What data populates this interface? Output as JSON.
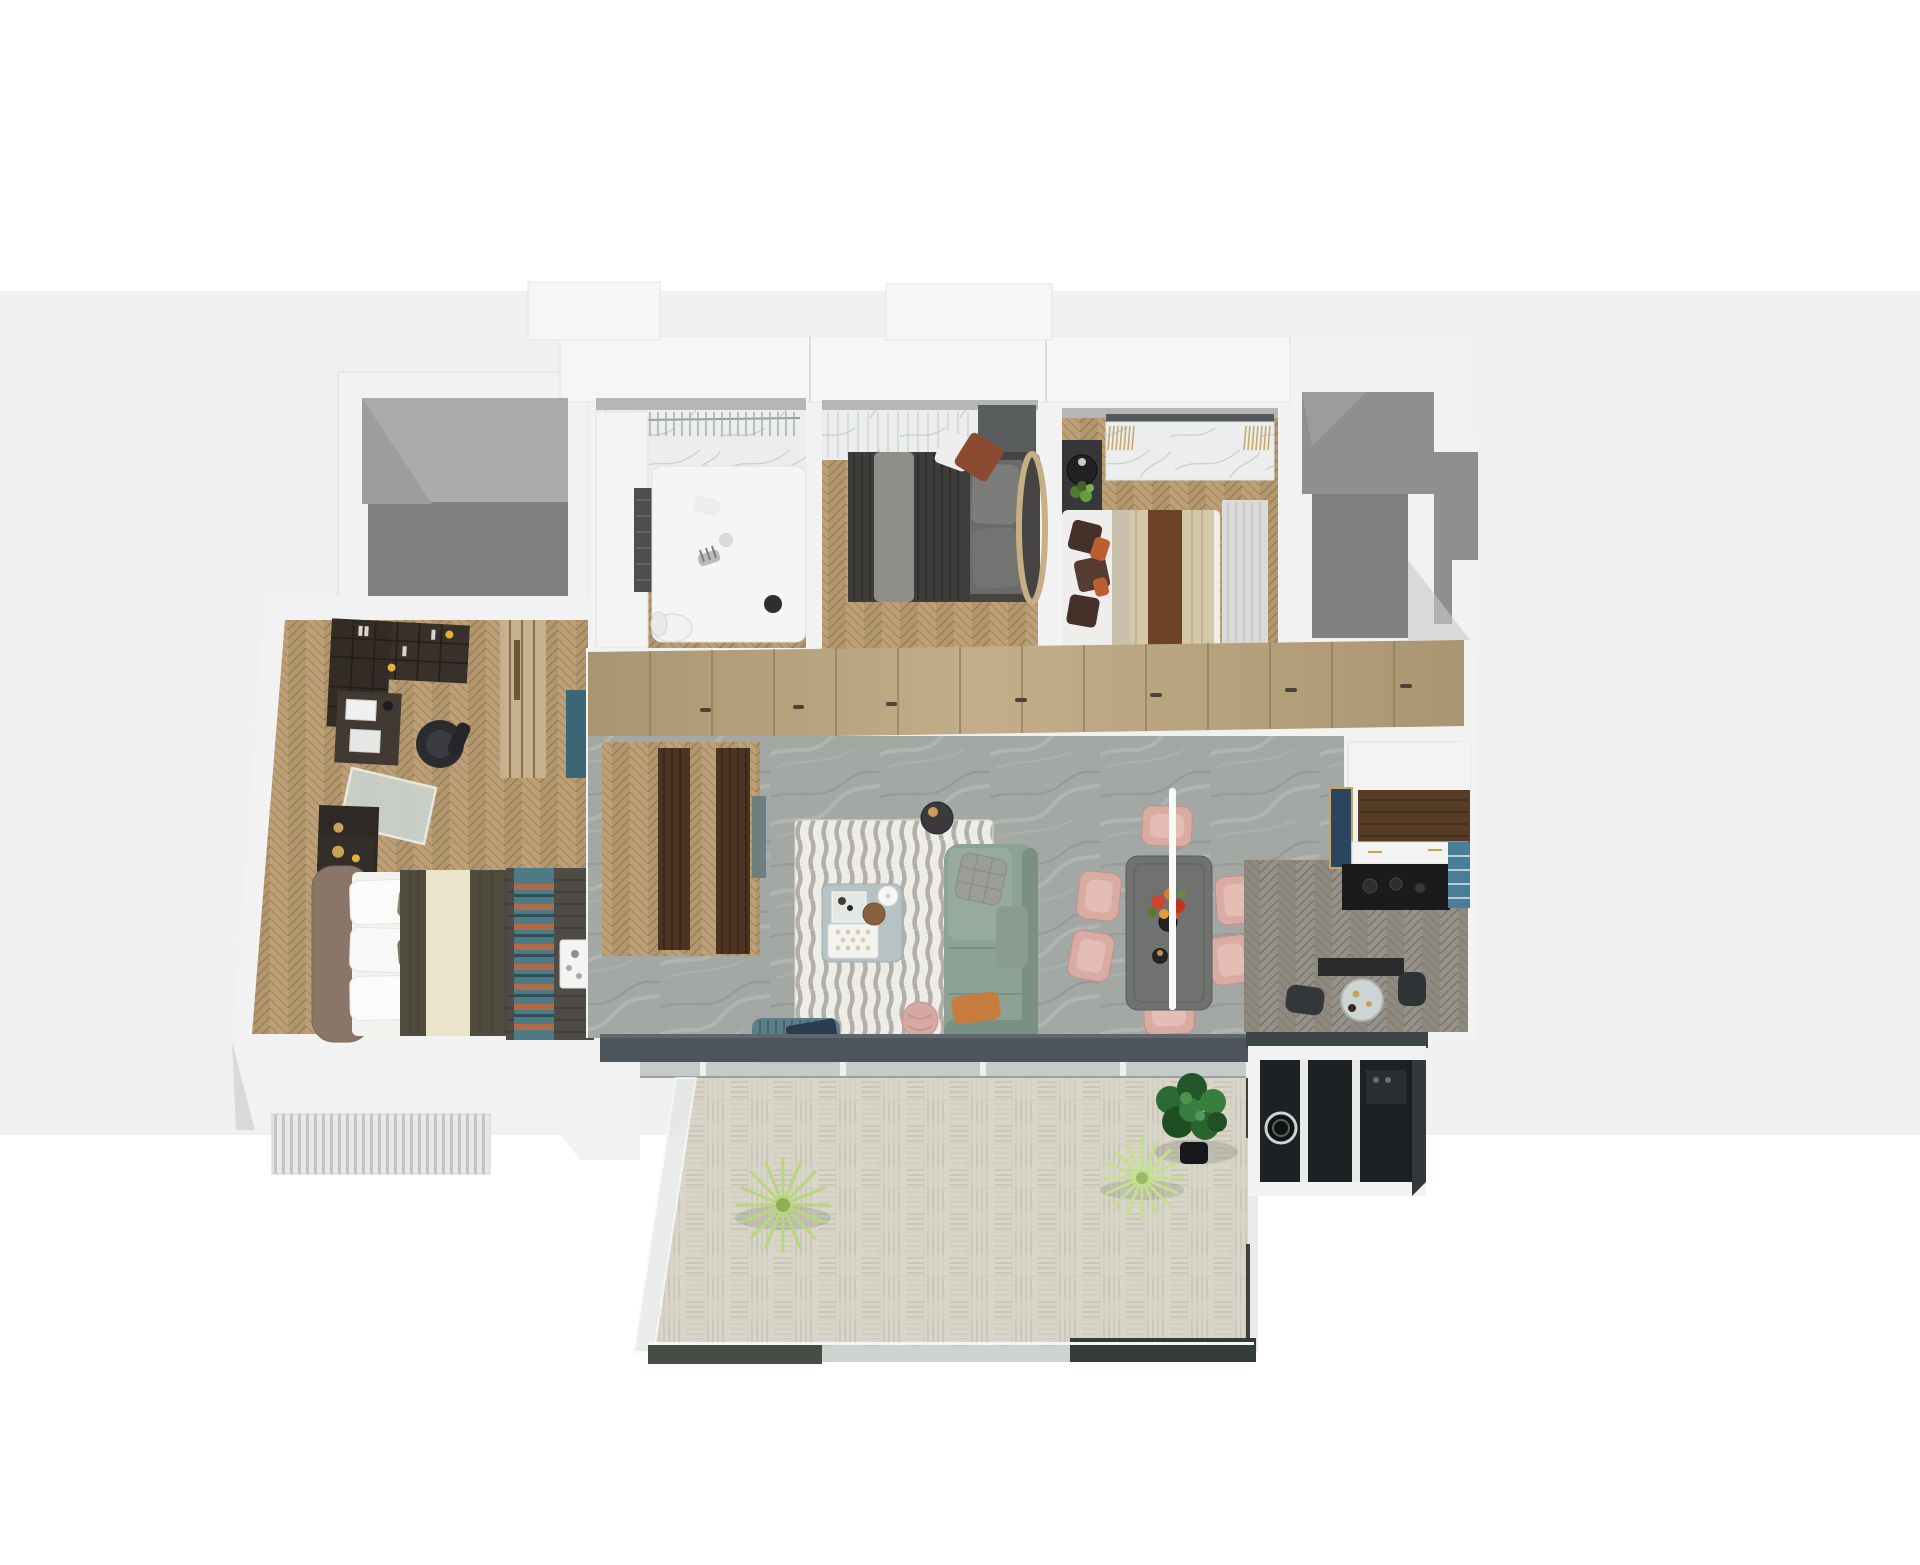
{
  "canvas": {
    "width": 1920,
    "height": 1565
  },
  "scene": {
    "type": "3d-floor-plan-render",
    "view": "top-down axonometric dollhouse view of an apartment",
    "background": {
      "top_color_key": "bg-top",
      "band_color_key": "bg-band",
      "band_top_px": 291,
      "band_bottom_px": 1135
    },
    "rooms": [
      {
        "id": "terrace-void",
        "label": "open terrace / light well",
        "floor": "gray concrete two-tone",
        "furniture": []
      },
      {
        "id": "kids-bedroom",
        "label": "kids bedroom",
        "floor": "white marble + oak herringbone",
        "furniture": [
          "wardrobe rail with hangers",
          "white platform bed",
          "zebra plush toy",
          "white desk chair",
          "tall dark shelf"
        ]
      },
      {
        "id": "bedroom-2",
        "label": "bedroom with dark bed",
        "floor": "oak herringbone",
        "furniture": [
          "marble headboard wall with sheer curtain",
          "dark striped duvet bed",
          "gray throw",
          "white and rust accent pillows",
          "rattan headboard arc",
          "dark side panel"
        ]
      },
      {
        "id": "bedroom-3",
        "label": "bedroom with striped blanket",
        "floor": "oak herringbone",
        "furniture": [
          "marble console with fringed runners",
          "black round side table with plant",
          "bed with cream and brown striped blanket",
          "dark brown pillows with orange accents",
          "sheer curtain"
        ]
      },
      {
        "id": "stairwell-void",
        "label": "stairwell / elevator void",
        "floor": "gray concrete steps",
        "furniture": []
      },
      {
        "id": "master-suite",
        "label": "master bedroom with study",
        "floor": "oak herringbone",
        "furniture": [
          "dark bookshelf wall unit",
          "desk with monitor",
          "black office chair",
          "glass dressing table",
          "dark vanity cabinet with gold decor",
          "light wood wardrobe",
          "teal cabinet",
          "nightstand",
          "bed with brown headboard, olive duvet and cream stripe",
          "woven bench with teal-rust zigzag throw and white tray",
          "slatted bay bench"
        ]
      },
      {
        "id": "hallway",
        "label": "hallway storage wall",
        "floor": "wardrobe top band",
        "furniture": [
          "full-length tan sliding wardrobes with handles",
          "pendant lamp"
        ]
      },
      {
        "id": "living-room",
        "label": "living room",
        "floor": "gray marble",
        "furniture": [
          "striped area rug",
          "sage green sofa",
          "quilted gray pillow",
          "orange lumbar pillow",
          "blue-gray coffee table with trays, basket and teapot",
          "dark round side table with candle",
          "teal pleated armchair with navy tablet",
          "pink round pouf",
          "walnut door jambs",
          "glass door leaf"
        ]
      },
      {
        "id": "dining-area",
        "label": "dining area",
        "floor": "gray marble",
        "furniture": [
          "dark rectangular dining table",
          "six blush pink chairs",
          "red-orange flower centerpiece",
          "white pendant cord",
          "black candle holder"
        ]
      },
      {
        "id": "kitchen",
        "label": "kitchen",
        "floor": "gray-brown herringbone",
        "furniture": [
          "white island",
          "walnut countertop",
          "navy cabinet panel with gold frame",
          "black cooktop run",
          "blue open shelf",
          "round glass bar table with stools"
        ]
      },
      {
        "id": "utility-balcony",
        "label": "utility balcony",
        "floor": "dark",
        "furniture": [
          "black glazed sliding panels",
          "washing machine",
          "small appliance"
        ]
      },
      {
        "id": "main-balcony",
        "label": "main balcony",
        "floor": "pale basket-weave decking",
        "furniture": [
          "dark window sill track",
          "glass balustrade",
          "fiddle-leaf fig in black pot",
          "two light green spiky plants"
        ]
      }
    ]
  },
  "palette": {
    "bg-top": "#ffffff",
    "bg-band": "#f0f0f1",
    "wall": "#f1f2f1",
    "wall-shade": "#d7dad9",
    "ledge": "#b4b7b6",
    "void-light": "#a9aca9",
    "void-mid": "#8d908d",
    "void-dark": "#7e817e",
    "wood-base": "#b3976e",
    "wood-base2": "#bda078",
    "wood-line": "#977b53",
    "woodgray-base": "#96928a",
    "woodgray-base2": "#8e8a80",
    "woodgray-line": "#77736a",
    "marble-white": "#ebeeed",
    "marble-vein": "#c8cecd",
    "marblegray-base": "#a3a8a4",
    "marblegray-vein": "#b9beb9",
    "marblegray-dark": "#8d928e",
    "wardrobe-light": "#c2ae89",
    "wardrobe-dark": "#a9956f",
    "wardrobe-seam": "#8b7a59",
    "handle-dark": "#4a4336",
    "deck": "#d9d5c9",
    "deck-line": "#c5c1b3",
    "sill": "#4d555a",
    "rail-glass": "#ced3d0",
    "rail-dark1": "#454d44",
    "rail-dark2": "#343c38",
    "rug": "#edece7",
    "rug-stripe": "#b2afa8",
    "sofa": "#8ca295",
    "sofa-dark": "#7a9084",
    "pillow-quilt": "#9b9d99",
    "pillow-orange": "#c67c3e",
    "coffee-table": "#b6c2c4",
    "side-dark": "#3a3a3c",
    "chair-teal": "#5b7e88",
    "tablet-navy": "#2b3c50",
    "pouf-pink": "#d7a7a1",
    "dining-table": "#6f726e",
    "chair-pink": "#d9aba3",
    "chair-pink-inner": "#e4bdb5",
    "flower-red": "#cf4430",
    "flower-orange": "#e2772c",
    "leaf-green": "#5c7a36",
    "island-white": "#f3f3f1",
    "walnut": "#563b26",
    "navy-panel": "#2b4560",
    "gold": "#c8a258",
    "cooktop": "#1b1b1d",
    "shelf-blue": "#4a7e98",
    "bed-head": "#8a7668",
    "duvet-olive": "#4f4c3d",
    "duvet-cream": "#ebe3ca",
    "pillow-olive": "#8b8371",
    "bench-dark": "#4f4c46",
    "throw-teal": "#4d7a85",
    "throw-rust": "#b06a48",
    "bookshelf": "#38302a",
    "office-chair": "#2c2c30",
    "teal-cabinet": "#3c6673",
    "wood-light": "#c7b08d",
    "duvet2-dark": "#3e3d3b",
    "pillow-rust": "#8d4a33",
    "rattan": "#c8ae85",
    "panel-gray": "#5a5d5e",
    "blanket-cream": "#d5c8a8",
    "blanket-brown": "#6e4226",
    "pillow-brown": "#46302a",
    "accent-orange": "#bb5f33",
    "curtain": "#dadad8",
    "fig-green1": "#2c6a33",
    "fig-green2": "#235628",
    "fig-green3": "#3a7d40",
    "spiky-green": "#b7d77c",
    "pot-black": "#17181a",
    "glass-utility": "#1e2124",
    "walnut-jamb": "#4c3423"
  }
}
